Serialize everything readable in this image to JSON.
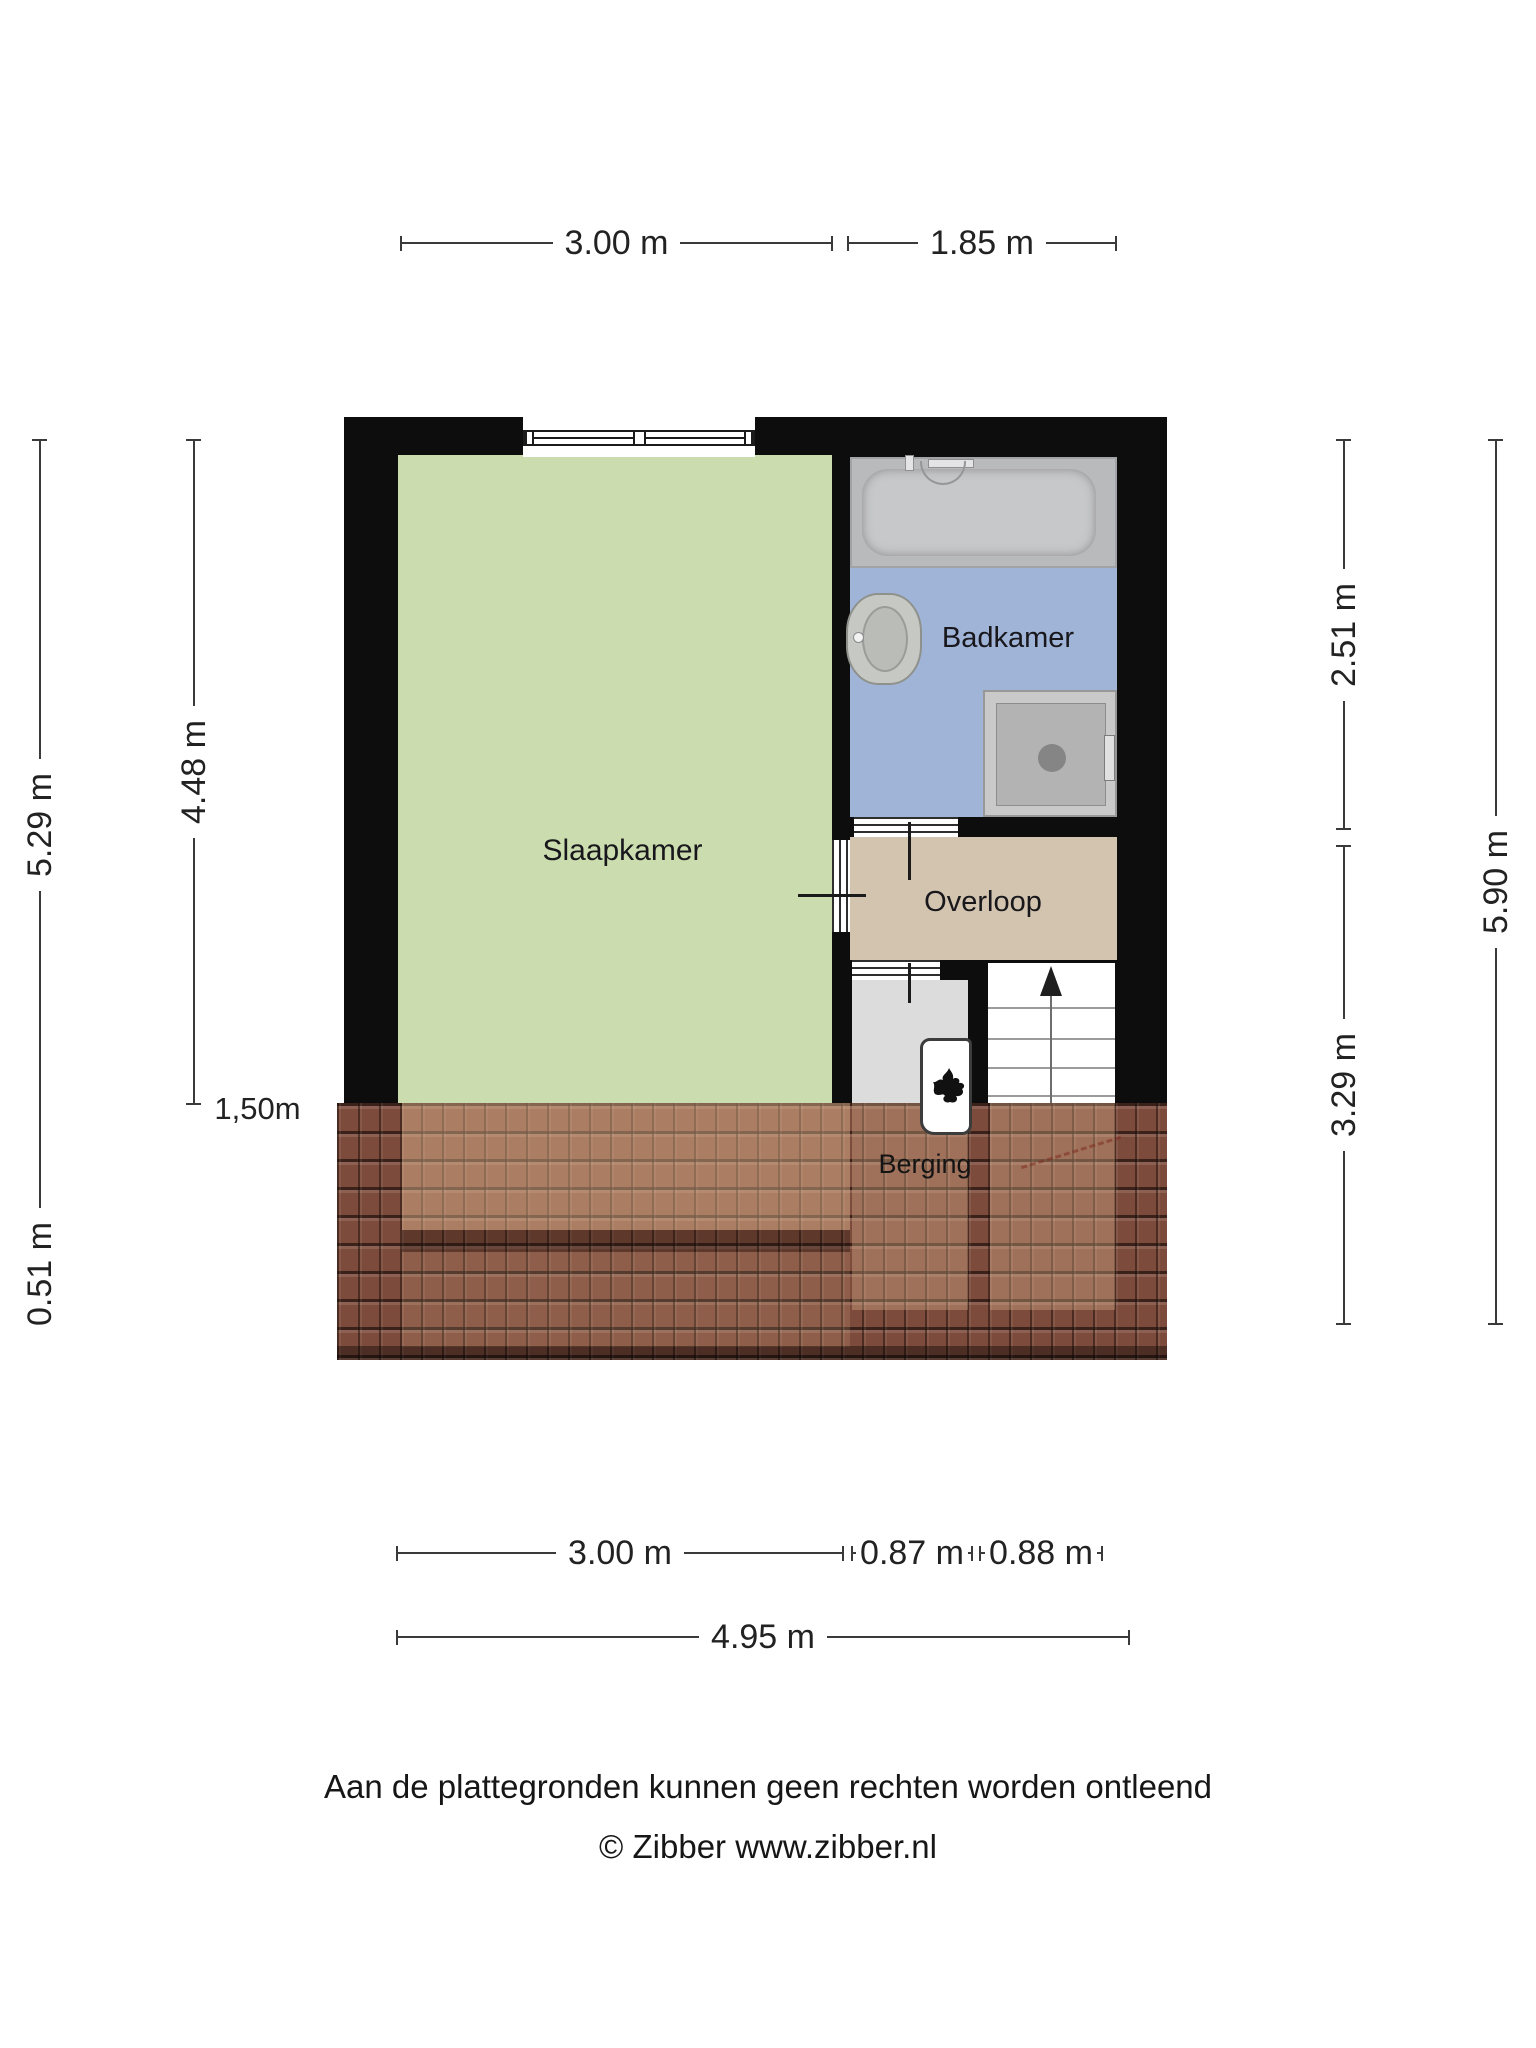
{
  "plan_title": "Floor plan - attic storey",
  "dims": {
    "top": [
      {
        "label": "3.00 m"
      },
      {
        "label": "1.85 m"
      }
    ],
    "bottom": [
      {
        "label": "3.00 m"
      },
      {
        "label": "0.87 m"
      },
      {
        "label": "0.88 m"
      },
      {
        "label": "4.95 m"
      }
    ],
    "left": [
      {
        "label": "5.29 m"
      },
      {
        "label": "4.48 m"
      },
      {
        "label": "0.51 m"
      }
    ],
    "right": [
      {
        "label": "2.51 m"
      },
      {
        "label": "3.29 m"
      },
      {
        "label": "5.90 m"
      }
    ],
    "roof_height_marker": {
      "label": "1,50m"
    }
  },
  "rooms": {
    "slaapkamer": {
      "label": "Slaapkamer"
    },
    "badkamer": {
      "label": "Badkamer"
    },
    "overloop": {
      "label": "Overloop"
    },
    "berging": {
      "label": "Berging"
    }
  },
  "fixtures": {
    "bathtub": "bathtub-icon",
    "washbasin": "washbasin-icon",
    "shower": "shower-icon",
    "staircase": "staircase-up-arrow-icon",
    "boiler": "boiler-flame-icon",
    "window": "window-icon",
    "roof": "roof-tiles-texture"
  },
  "footer": {
    "line1": "Aan de plattegronden kunnen geen rechten worden ontleend",
    "line2": "© Zibber www.zibber.nl"
  },
  "colors": {
    "wall": "#0d0d0d",
    "slaapkamer": "#cbdcae",
    "badkamer": "#a0b4d8",
    "overloop": "#d3c4af",
    "berging_room": "#dcdcdc",
    "roof": "#7c4b3b",
    "fixture_gray": "#b9babc"
  }
}
